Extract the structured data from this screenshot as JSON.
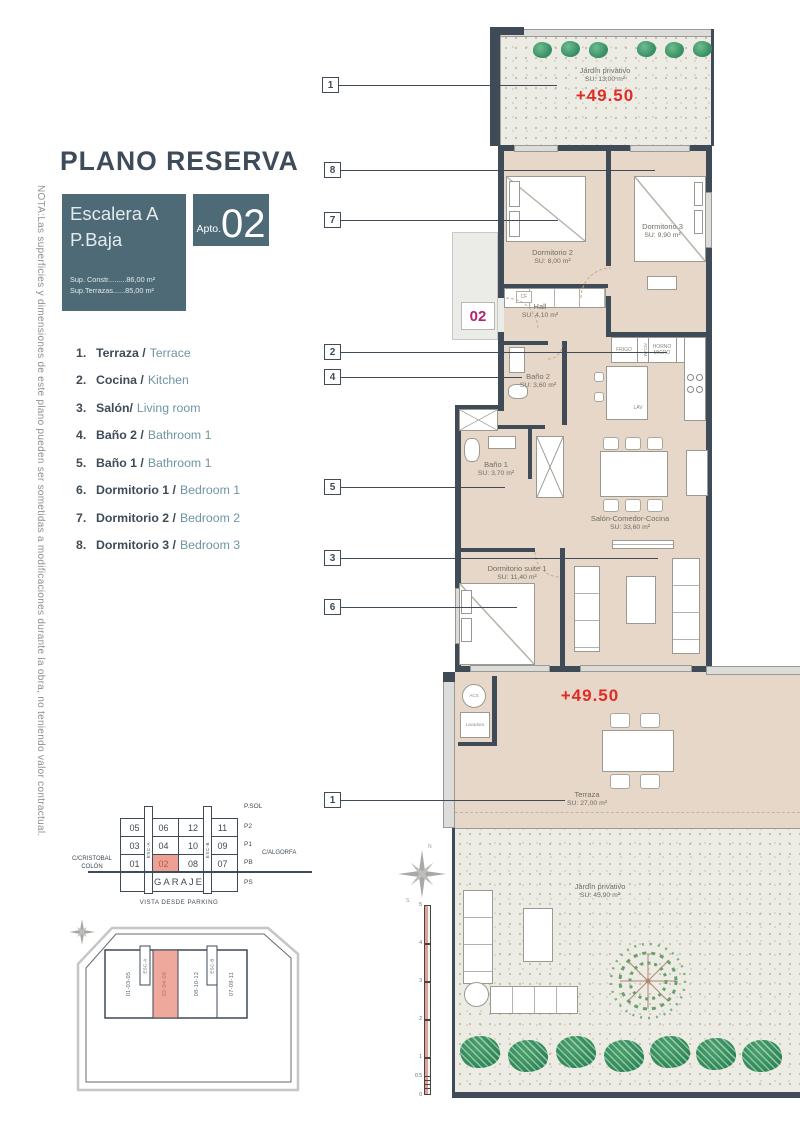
{
  "title": "PLANO RESERVA",
  "nota": "NOTA:Las superficies y dimensiones de este plano pueden ser sometidas a modificaciones durante la obra, no teniendo valor contractual.",
  "info_box": {
    "escalera": "Escalera A",
    "planta": "P.Baja",
    "sup_constr": "Sup. Constr.........86,00 m²",
    "sup_terrazas": "Sup.Terrazas......85,00 m²"
  },
  "apto": {
    "label": "Apto.",
    "number": "02"
  },
  "legend": [
    {
      "num": "1.",
      "es": "Terraza /",
      "en": "Terrace"
    },
    {
      "num": "2.",
      "es": "Cocina /",
      "en": "Kitchen"
    },
    {
      "num": "3.",
      "es": "Salón/",
      "en": "Living room"
    },
    {
      "num": "4.",
      "es": "Baño 2 /",
      "en": "Bathroom 1"
    },
    {
      "num": "5.",
      "es": "Baño 1 /",
      "en": "Bathroom 1"
    },
    {
      "num": "6.",
      "es": "Dormitorio 1 /",
      "en": "Bedroom 1"
    },
    {
      "num": "7.",
      "es": "Dormitorio 2 /",
      "en": "Bedroom 2"
    },
    {
      "num": "8.",
      "es": "Dormitorio 3 /",
      "en": "Bedroom 3"
    }
  ],
  "plan": {
    "unit_badge": "02",
    "elevation": "+49.50",
    "callouts": [
      "1",
      "8",
      "7",
      "2",
      "4",
      "5",
      "3",
      "6",
      "1"
    ],
    "rooms": {
      "jardin_top": {
        "name": "Jardín privativo",
        "area": "SU: 13,00 m²"
      },
      "dorm2": {
        "name": "Dormitorio 2",
        "area": "SU: 8,00 m²"
      },
      "dorm3": {
        "name": "Dormitorio 3",
        "area": "SU: 9,90 m²"
      },
      "hall": {
        "name": "Hall",
        "area": "SU: 4,10 m²"
      },
      "bano2": {
        "name": "Baño 2",
        "area": "SU: 3,60 m²"
      },
      "bano1": {
        "name": "Baño 1",
        "area": "SU: 3,70 m²"
      },
      "salon": {
        "name": "Salón-Comedor-Cocina",
        "area": "SU: 33,60 m²"
      },
      "suite": {
        "name": "Dormitorio suite 1",
        "area": "SU: 11,40 m²"
      },
      "terraza": {
        "name": "Terraza",
        "area": "SU: 27,00 m²"
      },
      "jardin_bottom": {
        "name": "Jardín privativo",
        "area": "SU: 45,90 m²"
      }
    },
    "appliances": {
      "frigo": "FRIGO",
      "acum": "ACUM.",
      "horno": "HORNO MICRO",
      "lav": "LAV",
      "cf": "CF",
      "acs": "ACS",
      "lavadora": "Lavadora"
    },
    "scale_ticks": [
      "5",
      "4",
      "3",
      "2",
      "1",
      "0.5",
      "0"
    ],
    "compass": {
      "n": "N",
      "s": "S"
    }
  },
  "garage": {
    "rows": [
      [
        "05",
        "06",
        "12",
        "11"
      ],
      [
        "03",
        "04",
        "10",
        "09"
      ],
      [
        "01",
        "02",
        "08",
        "07"
      ]
    ],
    "garaje": "GARAJE",
    "floors": [
      "P.SOL",
      "P2",
      "P1",
      "PB",
      "PS"
    ],
    "street_left_1": "C/CRISTOBAL",
    "street_left_2": "COLÓN",
    "street_right": "C/ALGORFA",
    "stair_a": "ESC-A",
    "stair_b": "ESC-B",
    "caption": "VISTA DESDE PARKING"
  },
  "siteplan": {
    "blocks": [
      "01-03-05",
      "02-04-06",
      "08-10-12",
      "07-09-11"
    ],
    "stair_a": "ESC-A",
    "stair_b": "ESC-B"
  },
  "colors": {
    "wall": "#3f4b57",
    "teal": "#4d6a76",
    "accent_red": "#e12b24",
    "magenta": "#b5256d",
    "salmon": "#eda194",
    "floor": "#e7d7c8"
  }
}
